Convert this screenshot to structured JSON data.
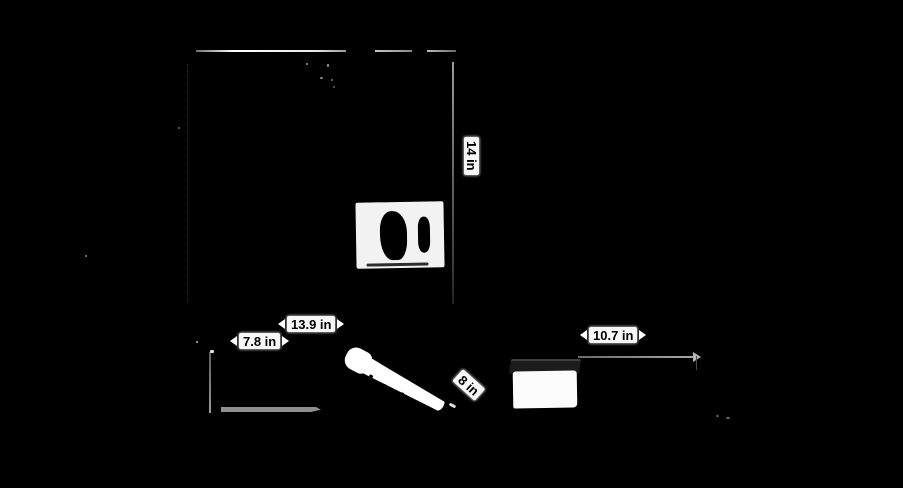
{
  "meta": {
    "kind": "product dimension photo on black background",
    "background_color": "#000000",
    "line_color": "#9a9a9a",
    "label_bg_color": "#f7f7f7",
    "label_text_color": "#000000"
  },
  "objects": {
    "sleeve_top_view": "large dark sleeve seen from top with white brand label patch",
    "sleeve_front_view": "dark sleeve front with gray base edge",
    "stylus": "white stylus pen lying diagonally",
    "accessory_box": "small box with white body and dark lid"
  },
  "dimensions": {
    "height_vertical": {
      "value": "14 in",
      "orientation": "vertical"
    },
    "width_top": {
      "value": "13.9 in",
      "orientation": "horizontal"
    },
    "depth_front": {
      "value": "7.8 in",
      "orientation": "horizontal"
    },
    "pen_length": {
      "value": "8 in",
      "orientation": "diagonal"
    },
    "accessory_width": {
      "value": "10.7 in",
      "orientation": "horizontal"
    }
  }
}
